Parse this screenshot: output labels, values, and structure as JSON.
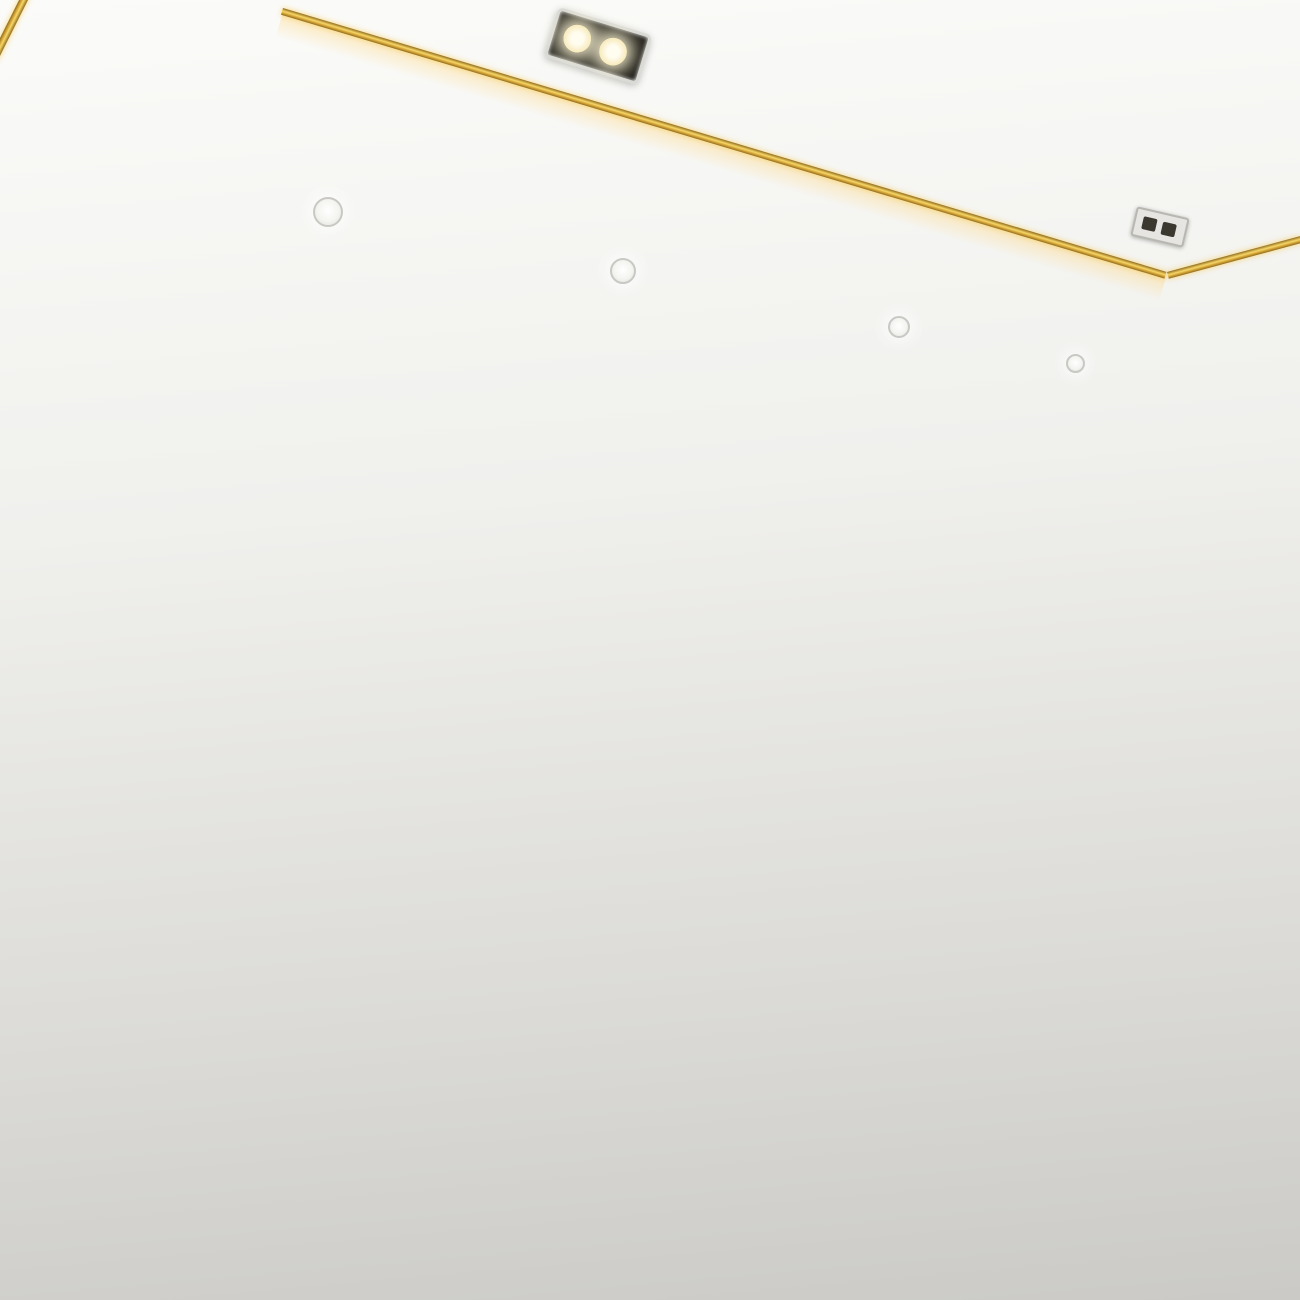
{
  "scene": {
    "title": "Modern living room with 3D black tunnel feature wall",
    "style": "photorealistic interior render",
    "objects": [
      "recessed tray ceiling with gold trim and warm cove lighting",
      "twin recessed spotlight fixture",
      "square recessed fixture",
      "four round downlights on soffit",
      "hallway downlight",
      "black 3D block tunnel mural wall",
      "vertical gold wall strips",
      "hallway with sliding fabric panels and dark doorway",
      "hardwood plank floor with brass transition strip",
      "glossy cream marble floor with reflections",
      "TV console with marble top, teal fluted band and gold loop legs",
      "glass vase with green plant",
      "stacked books",
      "white speckled two-tier jar",
      "gold-frame nesting coffee tables with marble tops",
      "dark stone tea tray with wooden caddies, cups and teapots",
      "blue watercolor rug with charcoal border",
      "bay window with autumn trees and green lawn",
      "window seat with gray cushion and black pillows",
      "greige textured right wall"
    ],
    "counts": {
      "soffit_downlights": 4,
      "gold_wall_strips": 6,
      "ceiling_fixtures": 2
    }
  },
  "palette": {
    "gold": "#d4a437",
    "goldLight": "#f7d768",
    "goldDark": "#8f6b1c",
    "tray": "#f5f4f1",
    "cove": "#f4e9cf",
    "crownLight": "#fbfbf9",
    "crownDark": "#cbcac6",
    "hallWall": "#e7e4de",
    "doorway": "#17181a",
    "panelTan": "#c39c6b",
    "panelGray": "#d7dad8",
    "wood": "#96592b",
    "wallBlack": "#0d0e11",
    "marbleFloor": "#f1ece3",
    "greige": "#c6c1b8",
    "windowFrame": "#3d3f41",
    "treeAmber": "#ab8a2e",
    "treeOlive": "#6d6424",
    "lawn": "#578b2d",
    "skyPatch": "#e9e7e2",
    "cushion": "#77797b",
    "pillowBlack": "#141516",
    "pillowGray": "#8b8d8f",
    "sill": "#f0efeb",
    "teal": "#1f6a73",
    "cream": "#efe8da",
    "marbleTop": "#f4f2ee",
    "rugBorder": "#3b3f3d",
    "rugBase": "#e7eff3",
    "rugBlue": "#4d7fb5",
    "trayDark": "#2e3134",
    "woodBox": "#9a6233",
    "plant": "#55813d",
    "jarWhite": "#f1efe9"
  },
  "tunnel": {
    "center": {
      "x": 600,
      "y": 715
    },
    "hole": {
      "rx": 81,
      "ry": 99
    },
    "rings": [
      {
        "rx": 560,
        "ry": 645,
        "a": "#121318",
        "b": "#0d0e11",
        "seg": 15
      },
      {
        "rx": 448,
        "ry": 515,
        "a": "#16181d",
        "b": "#101216",
        "seg": 16
      },
      {
        "rx": 356,
        "ry": 408,
        "a": "#1c1f25",
        "b": "#14161b",
        "seg": 17
      },
      {
        "rx": 287,
        "ry": 327,
        "a": "#23262d",
        "b": "#191c21",
        "seg": 19
      },
      {
        "rx": 230,
        "ry": 260,
        "a": "#2c3038",
        "b": "#20242b",
        "seg": 21
      },
      {
        "rx": 184,
        "ry": 208,
        "a": "#363b44",
        "b": "#282d34",
        "seg": 23
      },
      {
        "rx": 148,
        "ry": 167,
        "a": "#434955",
        "b": "#333941",
        "seg": 25
      },
      {
        "rx": 118,
        "ry": 134,
        "a": "#545b66",
        "b": "#41474f",
        "seg": 27
      },
      {
        "rx": 95,
        "ry": 108,
        "a": "#666e79",
        "b": "#525861",
        "seg": 29
      }
    ],
    "lightRings": [
      {
        "rx": 122,
        "ry": 138,
        "a": "#9aa1aa",
        "b": "#7e858e",
        "seg": 13,
        "clip": "polygon(0% 0%, 48% 0%, 30% 55%, 52% 100%, 0% 100%)",
        "rot": -14
      },
      {
        "rx": 100,
        "ry": 114,
        "a": "#c9ced4",
        "b": "#a9aeb5",
        "seg": 14,
        "clip": "polygon(0% 6%, 52% 0%, 26% 52%, 46% 100%, 0% 100%)",
        "rot": -12
      }
    ]
  }
}
